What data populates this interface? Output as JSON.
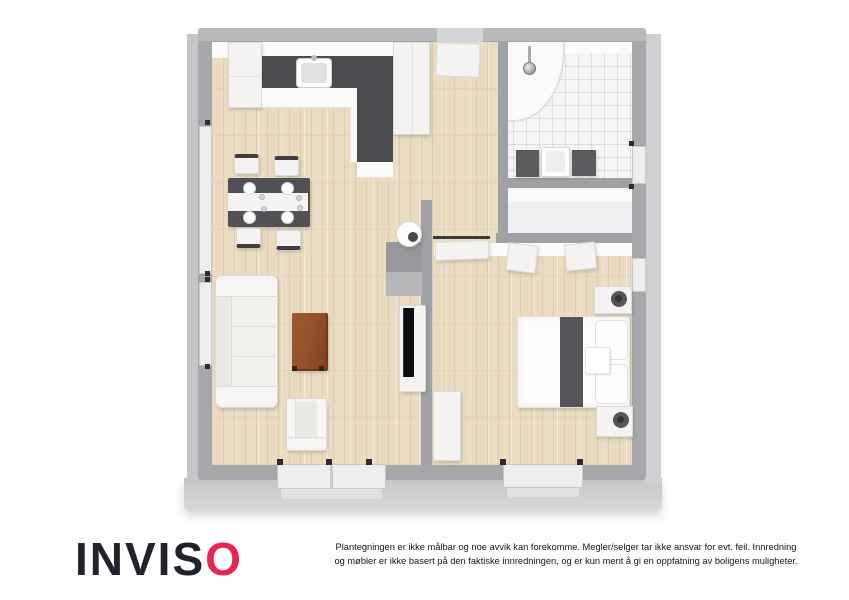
{
  "branding": {
    "logo_text_main": "INVIS",
    "logo_text_accent": "O",
    "logo_color_main": "#23222a",
    "logo_color_accent": "#ea2550"
  },
  "disclaimer": {
    "line1": "Plantegningen er ikke målbar og noe avvik kan forekomme. Megler/selger tar ikke ansvar for evt. feil. Innredning",
    "line2": "og møbler er ikke basert på den faktiske innredningen, og er kun ment å gi en oppfatning av boligens muligheter."
  },
  "floorplan": {
    "description": "3D top-down floor plan of a one-bedroom apartment",
    "rooms": [
      "open-kitchen-dining-living-room",
      "entrance-hall",
      "bathroom",
      "closet",
      "bedroom"
    ],
    "elements": {
      "kitchen": [
        "fridge-cabinet",
        "tall-cabinet-column",
        "l-shaped-counter-dark-top",
        "kitchen-sink"
      ],
      "dining": [
        "dark-dining-table",
        "white-table-runner",
        "four-place-settings",
        "four-chairs"
      ],
      "living": [
        "three-seat-sofa",
        "wooden-coffee-table",
        "armchair",
        "tv-on-media-bench",
        "sideboard-with-round-lamp"
      ],
      "bathroom": [
        "corner-shower-with-chrome-fixture",
        "vanity-dark-cabinets-white-sink",
        "tiled-floor"
      ],
      "bedroom": [
        "double-bed-white-duvet",
        "dark-bed-runner",
        "two-pillows",
        "bed-tray",
        "two-nightstands-with-dark-lamps",
        "white-wardrobe",
        "closet-sliding-panels"
      ],
      "openings": [
        "front-door-top-wall",
        "bedroom-sliding-door",
        "left-wall-windows",
        "right-wall-windows",
        "bottom-wall-windows"
      ]
    },
    "colors": {
      "wall": "#a5a7aa",
      "wall_outer_face": "#c7c9cb",
      "wood_floor": "#e9dcc2",
      "tile_floor": "#f5f5f4",
      "counter_top": "#4b4b4f",
      "coffee_table_wood": "#94512a",
      "bed_runner": "#56565a",
      "furniture_white": "#f4f3f1"
    }
  }
}
